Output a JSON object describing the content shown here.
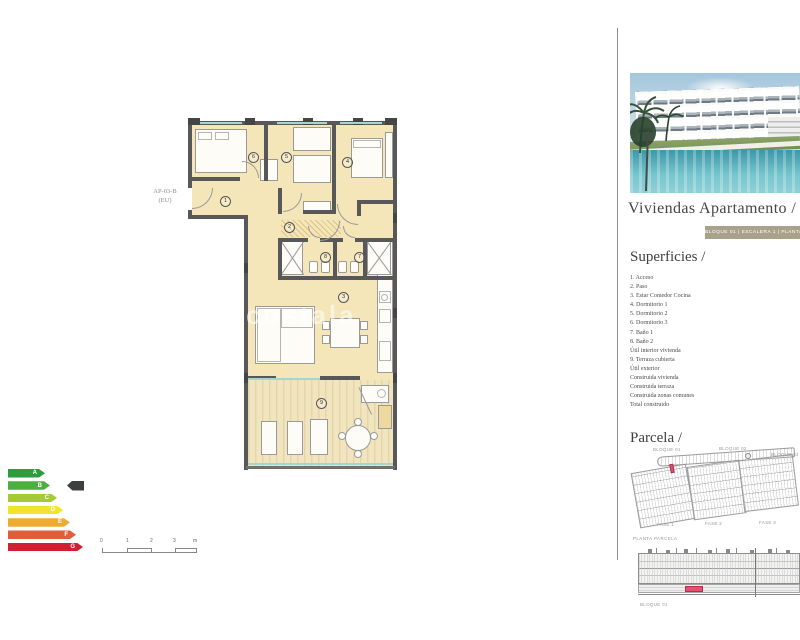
{
  "floor_plan": {
    "unit_label_line1": "AP-03-B",
    "unit_label_line2": "(EU)",
    "watermark": "costala",
    "room_numbers": [
      "1",
      "2",
      "3",
      "4",
      "5",
      "6",
      "7",
      "8",
      "9"
    ]
  },
  "energy_label": {
    "levels": [
      {
        "letter": "A",
        "color": "#2e9b41"
      },
      {
        "letter": "B",
        "color": "#4caf3e"
      },
      {
        "letter": "C",
        "color": "#a6c938"
      },
      {
        "letter": "D",
        "color": "#f2e32c"
      },
      {
        "letter": "E",
        "color": "#eeab33"
      },
      {
        "letter": "F",
        "color": "#e05f3a"
      },
      {
        "letter": "G",
        "color": "#d1202f"
      }
    ],
    "selected": "B",
    "indicator_color": "#3d4042"
  },
  "scale_bar": {
    "tick0": "0",
    "tick1": "1",
    "tick2": "2",
    "tick3": "3",
    "unit": "m"
  },
  "sidebar": {
    "title": "Viviendas Apartamento /",
    "banner": "BLOQUE 01 | ESCALERA 1 | PLANTA",
    "superficies_heading": "Superficies /",
    "superficies_items": [
      "1. Acceso",
      "2. Paso",
      "3. Estar Comedor Cocina",
      "4. Dormitorio 1",
      "5. Dormitorio 2",
      "6. Dormitorio 3",
      "7. Baño 1",
      "8. Baño 2",
      "Útil interior vivienda",
      "9. Terraza cubierta",
      "Útil exterior",
      "Construida vivienda",
      "Construida terraza",
      "Construida zonas comunes",
      "Total construido"
    ],
    "parcela_heading": "Parcela /",
    "parcela_blocks": [
      "BLOQUE 01",
      "BLOQUE 02",
      "BLOQUE 03"
    ],
    "parcela_fases": [
      "FASE 1",
      "FASE 2",
      "FASE 3"
    ],
    "parcela_caption": "PLANTA PARCELA",
    "elevation_label": "BLOQUE 01",
    "highlight_color": "#e4506e"
  }
}
